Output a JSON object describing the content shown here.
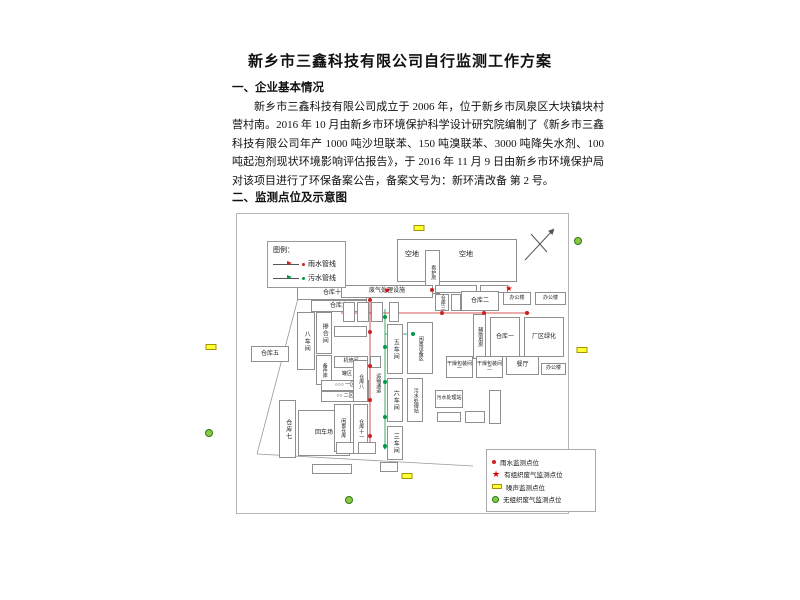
{
  "document": {
    "title": "新乡市三鑫科技有限公司自行监测工作方案",
    "section1_heading": "一、企业基本情况",
    "paragraph": "新乡市三鑫科技有限公司成立于 2006 年，位于新乡市凤泉区大块镇块村营村南。2016 年 10 月由新乡市环境保护科学设计研究院编制了《新乡市三鑫科技有限公司年产 1000 吨沙坦联苯、150 吨溴联苯、3000 吨降失水剂、100 吨起泡剂现状环境影响评估报告》，于 2016 年 11 月 9 日由新乡市环境保护局对该项目进行了环保备案公告，备案文号为：新环清改备 第 2 号。",
    "section2_heading": "二、监测点位及示意图"
  },
  "colors": {
    "rain": "#cc2222",
    "sewage": "#009944",
    "noise_fill": "#ffff33",
    "gas_fill": "#8bc943",
    "star": "#dd0000",
    "boundary": "#999999"
  },
  "pipe_legend": {
    "title": "图例：",
    "items": [
      {
        "label": "雨水管线",
        "color": "#cc2222"
      },
      {
        "label": "污水管线",
        "color": "#009944"
      }
    ]
  },
  "point_legend": {
    "items": [
      {
        "label": "雨水监测点位",
        "marker": "red-dot"
      },
      {
        "label": "有组织废气监测点位",
        "marker": "red-star"
      },
      {
        "label": "噪声监测点位",
        "marker": "yellow-rect"
      },
      {
        "label": "无组织废气监测点位",
        "marker": "green-circle"
      }
    ]
  },
  "map": {
    "buildings": [
      {
        "label": "",
        "x": 160,
        "y": 25,
        "w": 120,
        "h": 43
      },
      {
        "label": "空地",
        "x": 164,
        "y": 34,
        "w": 22,
        "h": 14,
        "nb": 1
      },
      {
        "label": "看护房",
        "x": 188,
        "y": 36,
        "w": 15,
        "h": 44,
        "v": 1,
        "tiny": 1
      },
      {
        "label": "空地",
        "x": 212,
        "y": 34,
        "w": 34,
        "h": 14,
        "nb": 1
      },
      {
        "label": "仓库十",
        "x": 60,
        "y": 73,
        "w": 70,
        "h": 13
      },
      {
        "label": "废气处理设施",
        "x": 104,
        "y": 71,
        "w": 92,
        "h": 13
      },
      {
        "label": "仓库九",
        "x": 74,
        "y": 86,
        "w": 56,
        "h": 12
      },
      {
        "label": "八车间",
        "x": 60,
        "y": 98,
        "w": 18,
        "h": 58,
        "v": 1
      },
      {
        "label": "掺合间",
        "x": 79,
        "y": 98,
        "w": 16,
        "h": 42,
        "v": 1
      },
      {
        "label": "",
        "x": 97,
        "y": 112,
        "w": 33,
        "h": 11
      },
      {
        "label": "仓库五",
        "x": 14,
        "y": 132,
        "w": 38,
        "h": 16
      },
      {
        "label": "备件库",
        "x": 79,
        "y": 141,
        "w": 16,
        "h": 30,
        "v": 1,
        "tiny": 1
      },
      {
        "label": "机修间",
        "x": 97,
        "y": 142,
        "w": 34,
        "h": 12,
        "tiny": 1
      },
      {
        "label": "",
        "x": 133,
        "y": 142,
        "w": 11,
        "h": 12
      },
      {
        "label": "罐区",
        "x": 98,
        "y": 156,
        "w": 24,
        "h": 9,
        "nb": 1,
        "tiny": 1
      },
      {
        "label": "○○○ 一区",
        "x": 84,
        "y": 166,
        "w": 48,
        "h": 11,
        "tiny": 1
      },
      {
        "label": "○○ 二区",
        "x": 84,
        "y": 177,
        "w": 48,
        "h": 11,
        "tiny": 1
      },
      {
        "label": "仓库七",
        "x": 42,
        "y": 186,
        "w": 17,
        "h": 58,
        "v": 1
      },
      {
        "label": "回车场",
        "x": 61,
        "y": 196,
        "w": 52,
        "h": 46
      },
      {
        "label": "闲置仓库",
        "x": 97,
        "y": 190,
        "w": 17,
        "h": 48,
        "v": 1,
        "tiny": 1
      },
      {
        "label": "仓库八",
        "x": 116,
        "y": 146,
        "w": 15,
        "h": 42,
        "v": 1,
        "tiny": 1
      },
      {
        "label": "仓库十一",
        "x": 116,
        "y": 190,
        "w": 15,
        "h": 50,
        "v": 1,
        "tiny": 1
      },
      {
        "label": "",
        "x": 75,
        "y": 250,
        "w": 40,
        "h": 10
      },
      {
        "label": "运输通道",
        "x": 134,
        "y": 140,
        "w": 13,
        "h": 58,
        "v": 1,
        "nb": 1,
        "tiny": 1
      },
      {
        "label": "",
        "x": 106,
        "y": 88,
        "w": 12,
        "h": 20
      },
      {
        "label": "",
        "x": 120,
        "y": 88,
        "w": 12,
        "h": 20
      },
      {
        "label": "",
        "x": 134,
        "y": 88,
        "w": 12,
        "h": 20
      },
      {
        "label": "",
        "x": 152,
        "y": 88,
        "w": 10,
        "h": 20
      },
      {
        "label": "五车间",
        "x": 150,
        "y": 110,
        "w": 16,
        "h": 50,
        "v": 1
      },
      {
        "label": "闲置设备区",
        "x": 170,
        "y": 108,
        "w": 26,
        "h": 52,
        "v": 1,
        "tiny": 1
      },
      {
        "label": "六车间",
        "x": 150,
        "y": 164,
        "w": 16,
        "h": 44,
        "v": 1
      },
      {
        "label": "污水处理站",
        "x": 170,
        "y": 164,
        "w": 16,
        "h": 44,
        "v": 1,
        "tiny": 1
      },
      {
        "label": "三车间",
        "x": 150,
        "y": 212,
        "w": 16,
        "h": 34,
        "v": 1
      },
      {
        "label": "",
        "x": 99,
        "y": 228,
        "w": 18,
        "h": 12
      },
      {
        "label": "",
        "x": 121,
        "y": 228,
        "w": 18,
        "h": 12
      },
      {
        "label": "",
        "x": 143,
        "y": 248,
        "w": 18,
        "h": 10
      },
      {
        "label": "",
        "x": 198,
        "y": 71,
        "w": 42,
        "h": 8,
        "tiny": 1
      },
      {
        "label": "",
        "x": 243,
        "y": 71,
        "w": 28,
        "h": 8,
        "tiny": 1
      },
      {
        "label": "仓库三",
        "x": 198,
        "y": 80,
        "w": 14,
        "h": 17,
        "v": 1,
        "tiny": 1
      },
      {
        "label": "",
        "x": 214,
        "y": 80,
        "w": 10,
        "h": 17
      },
      {
        "label": "仓库二",
        "x": 224,
        "y": 77,
        "w": 38,
        "h": 20
      },
      {
        "label": "办公楼",
        "x": 266,
        "y": 78,
        "w": 28,
        "h": 13,
        "tiny": 1
      },
      {
        "label": "办公楼",
        "x": 298,
        "y": 78,
        "w": 31,
        "h": 13,
        "tiny": 1
      },
      {
        "label": "辅助用房",
        "x": 236,
        "y": 100,
        "w": 13,
        "h": 45,
        "v": 1,
        "tiny": 1
      },
      {
        "label": "仓库一",
        "x": 253,
        "y": 103,
        "w": 30,
        "h": 40
      },
      {
        "label": "厂区绿化",
        "x": 287,
        "y": 103,
        "w": 40,
        "h": 40
      },
      {
        "label": "干燥包装间一",
        "x": 209,
        "y": 142,
        "w": 27,
        "h": 22,
        "tiny": 1
      },
      {
        "label": "干燥包装间二",
        "x": 239,
        "y": 142,
        "w": 27,
        "h": 22,
        "tiny": 1
      },
      {
        "label": "餐厅",
        "x": 269,
        "y": 142,
        "w": 33,
        "h": 19
      },
      {
        "label": "办公楼",
        "x": 304,
        "y": 149,
        "w": 25,
        "h": 12,
        "tiny": 1
      },
      {
        "label": "污水处理站",
        "x": 198,
        "y": 176,
        "w": 28,
        "h": 18,
        "tiny": 1
      },
      {
        "label": "",
        "x": 200,
        "y": 198,
        "w": 24,
        "h": 10
      },
      {
        "label": "",
        "x": 228,
        "y": 197,
        "w": 20,
        "h": 12
      },
      {
        "label": "",
        "x": 252,
        "y": 176,
        "w": 12,
        "h": 34
      }
    ],
    "markers": [
      {
        "t": "yellow-rect",
        "x": 182,
        "y": 14
      },
      {
        "t": "red-dot",
        "x": 195,
        "y": 76
      },
      {
        "t": "red-star",
        "x": 150,
        "y": 77
      },
      {
        "t": "red-star",
        "x": 272,
        "y": 75
      },
      {
        "t": "red-dot",
        "x": 133,
        "y": 86
      },
      {
        "t": "red-dot",
        "x": 133,
        "y": 118
      },
      {
        "t": "red-dot",
        "x": 133,
        "y": 152
      },
      {
        "t": "red-dot",
        "x": 133,
        "y": 186
      },
      {
        "t": "red-dot",
        "x": 133,
        "y": 222
      },
      {
        "t": "red-dot",
        "x": 205,
        "y": 99
      },
      {
        "t": "red-dot",
        "x": 247,
        "y": 99
      },
      {
        "t": "red-dot",
        "x": 290,
        "y": 99
      },
      {
        "t": "green-dot",
        "x": 148,
        "y": 103
      },
      {
        "t": "green-dot",
        "x": 148,
        "y": 133
      },
      {
        "t": "green-dot",
        "x": 148,
        "y": 168
      },
      {
        "t": "green-dot",
        "x": 148,
        "y": 203
      },
      {
        "t": "green-dot",
        "x": 148,
        "y": 232
      },
      {
        "t": "green-dot",
        "x": 176,
        "y": 120
      },
      {
        "t": "yellow-rect",
        "x": 170,
        "y": 262
      },
      {
        "t": "green-circle",
        "x": 112,
        "y": 286
      }
    ],
    "lines": {
      "boundary": [
        [
          64,
          73,
          20,
          240
        ],
        [
          20,
          240,
          236,
          252
        ]
      ],
      "rain": [
        [
          133,
          84,
          133,
          232
        ],
        [
          104,
          99,
          292,
          99
        ]
      ],
      "sewage": [
        [
          148,
          95,
          148,
          235
        ],
        [
          148,
          120,
          176,
          120
        ]
      ],
      "compass": [
        [
          288,
          46,
          316,
          16
        ],
        [
          294,
          20,
          310,
          38
        ]
      ]
    }
  },
  "page_markers": [
    {
      "t": "green-circle",
      "x": 578,
      "y": 241
    },
    {
      "t": "yellow-rect",
      "x": 211,
      "y": 347
    },
    {
      "t": "yellow-rect",
      "x": 582,
      "y": 350
    },
    {
      "t": "green-circle",
      "x": 209,
      "y": 433
    }
  ]
}
